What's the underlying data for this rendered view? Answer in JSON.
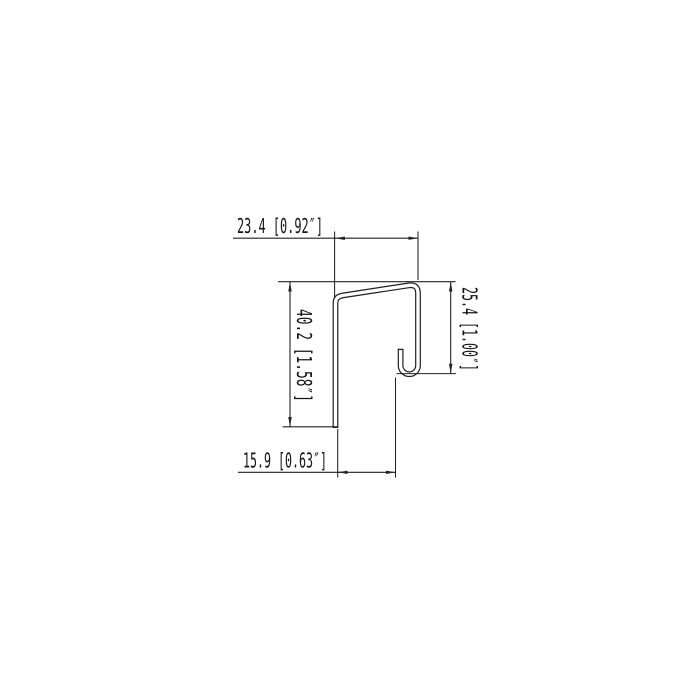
{
  "page": {
    "background": "#ffffff",
    "line_color": "#1f1f1f"
  },
  "drawing": {
    "kind": "technical-dimension-drawing",
    "subject": "sheet-metal J-channel trim profile cross-section",
    "dimensions": {
      "top_width": {
        "mm": "23.4",
        "inch": "0.92",
        "label": "23.4 [0.92″]"
      },
      "left_height": {
        "mm": "40.2",
        "inch": "1.58",
        "label": "40.2 [1.58″]"
      },
      "right_height": {
        "mm": "25.4",
        "inch": "1.00",
        "label": "25.4 [1.00″]"
      },
      "bottom_width": {
        "mm": "15.9",
        "inch": "0.63",
        "label": "15.9 [0.63″]"
      }
    }
  }
}
